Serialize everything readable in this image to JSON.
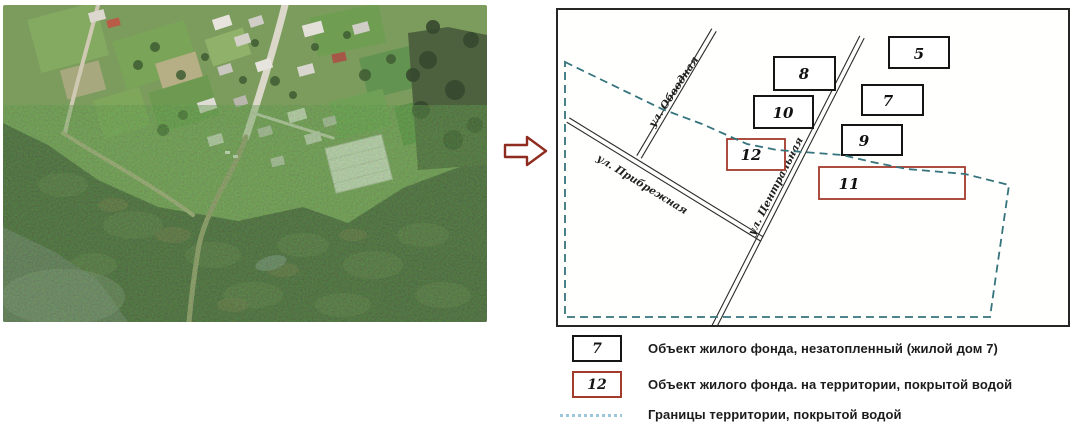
{
  "map": {
    "streets": [
      {
        "name": "ул. Обводная"
      },
      {
        "name": "ул. Прибрежная"
      },
      {
        "name": "ул. Центральная"
      }
    ],
    "buildings": [
      {
        "label": "5",
        "status": "dry"
      },
      {
        "label": "8",
        "status": "dry"
      },
      {
        "label": "7",
        "status": "dry"
      },
      {
        "label": "10",
        "status": "dry"
      },
      {
        "label": "9",
        "status": "dry"
      },
      {
        "label": "12",
        "status": "flooded"
      },
      {
        "label": "11",
        "status": "flooded"
      }
    ]
  },
  "legend": {
    "items": [
      {
        "symbol": "7",
        "text": "Объект жилого фонда, незатопленный (жилой дом 7)"
      },
      {
        "symbol": "12",
        "text": "Объект жилого фонда. на территории, покрытой водой"
      },
      {
        "symbol": "dashed-line",
        "text": "Границы территории, покрытой водой"
      }
    ]
  },
  "colors": {
    "normal_outline": "#151515",
    "flooded_outline": "#a23b2b",
    "boundary_dash": "#35747c",
    "legend_dash": "#9cc7da",
    "arrow_outline": "#8f2c20"
  }
}
